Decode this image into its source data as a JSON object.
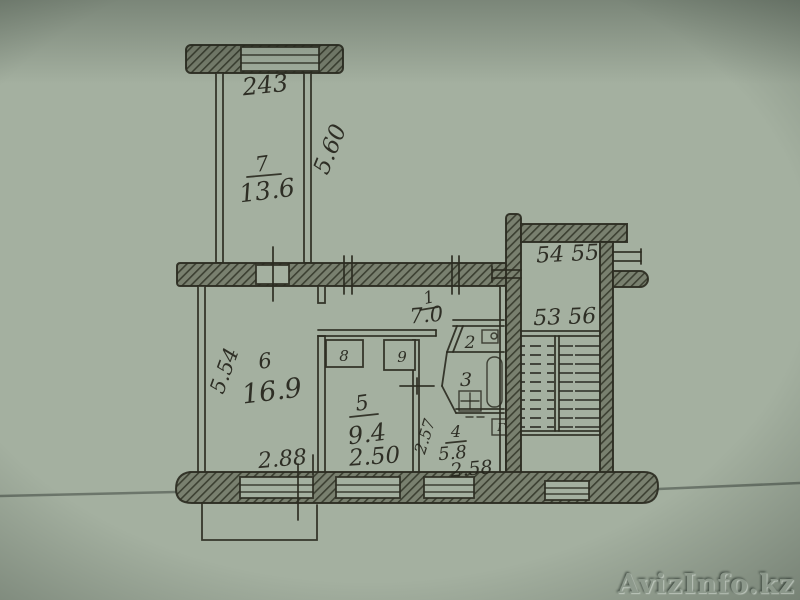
{
  "watermark": "AvizInfo.kz",
  "colors": {
    "paper": "#a4b0a0",
    "ink": "#2b2b21",
    "wall_shading": "#79806f",
    "vignette": "#0c160f"
  },
  "plan": {
    "balcony": {
      "width_label": "243",
      "height_label": "5.60"
    },
    "rooms": {
      "room7": {
        "number": "7",
        "area": "13.6"
      },
      "room6": {
        "number": "6",
        "area": "16.9"
      },
      "room5": {
        "number": "5",
        "area": "9.4",
        "width_label": "2.50"
      },
      "hall": {
        "number": "1",
        "area": "7.0"
      },
      "toilet": {
        "number": "2"
      },
      "bath": {
        "number": "3"
      },
      "kitchen": {
        "number": "4",
        "area": "5.8",
        "width_label": "2.58",
        "depth_label": "2.57"
      },
      "closet8": {
        "number": "8"
      },
      "closet9": {
        "number": "9"
      }
    },
    "dimensions": {
      "left_height": "5.54",
      "room6_window": "2.88"
    },
    "stairwell": {
      "flats_upper": "54 55",
      "flats_lower": "53 56",
      "chute_symbol": "Г"
    }
  }
}
